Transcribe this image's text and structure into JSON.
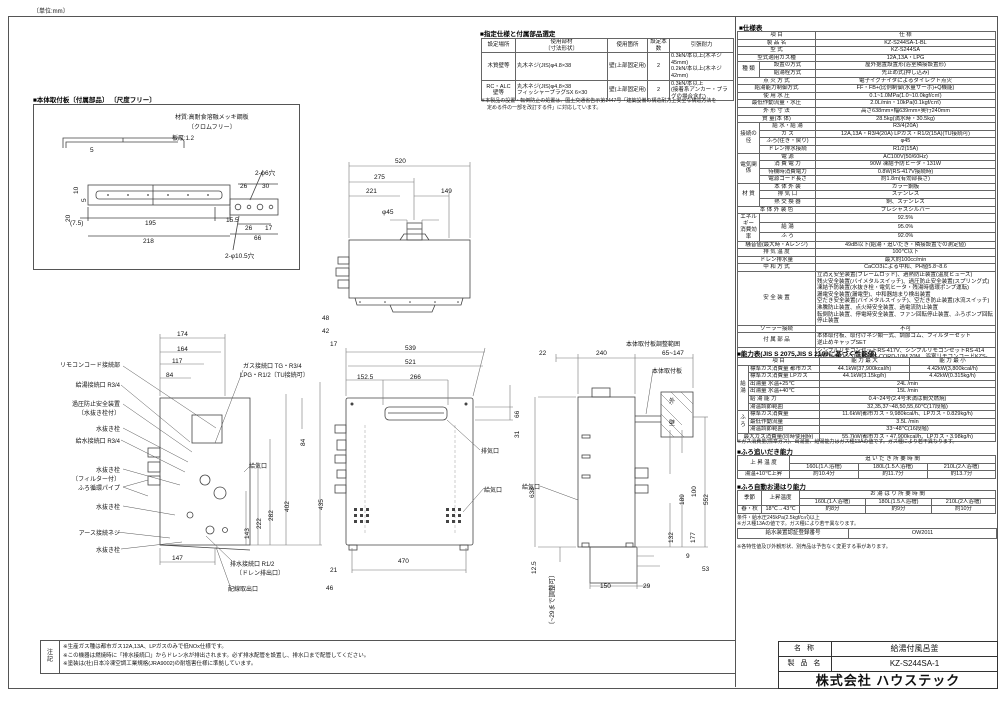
{
  "unit_note": "〔単位:mm〕",
  "supplied_parts": {
    "title": "■指定仕様と付属部品選定",
    "rows": [
      [
        {
          "t": "設定場所",
          "cl": "hd"
        },
        {
          "t": "使用部材\n〔寸法形状〕",
          "cl": "hd"
        },
        {
          "t": "使用箇所",
          "cl": "hd"
        },
        {
          "t": "設定本数",
          "cl": "hd"
        },
        {
          "t": "引張耐力",
          "cl": "hd"
        }
      ],
      [
        {
          "t": "木質壁等"
        },
        {
          "t": "丸木ネジ(JIS)φ4.8×38",
          "cl": "left"
        },
        {
          "t": "壁(上部固定用)"
        },
        {
          "t": "2"
        },
        {
          "t": "0.3kN/本以上(木ネジ45mm)\n0.2kN/本以上(木ネジ42mm)",
          "cl": "left"
        }
      ],
      [
        {
          "t": "RC・ALC\n壁等"
        },
        {
          "t": "丸木ネジ(JIS)φ4.8×38\nフィッシャープラグSX 6×30",
          "cl": "left"
        },
        {
          "t": "壁(上部固定用)"
        },
        {
          "t": "2"
        },
        {
          "t": "0.3kN/本以上\n(接着系アンカー・プラグの場合含む)",
          "cl": "left"
        }
      ]
    ],
    "note1": "※本製品の設置・転倒防止の処置は、国土交通省告示第1447号「建築設備の構造耐力上安全な構造方法を",
    "note2": "定める件の一部を改訂する件」に対応しています。"
  },
  "mounting_plate": {
    "title": "■本体取付板〔付属部品〕 〔尺度フリー〕",
    "material1": "材質:高耐食溶融メッキ鋼板",
    "material2": "〔クロムフリー〕",
    "thickness": "板厚:1.2",
    "d5p": "5",
    "d10": "10",
    "d5": "5",
    "d20": "20",
    "d7_5": "(7.5)",
    "d195": "195",
    "d15_5": "15.5",
    "d218": "218",
    "holes6": "2-φ6穴",
    "d26a": "26",
    "d30": "30",
    "d26b": "26",
    "d17": "17",
    "d66": "66",
    "holes10_5": "2-φ10.5穴"
  },
  "views": {
    "top": {
      "d520": "520",
      "d275": "275",
      "d221": "221",
      "d149": "149",
      "dphi45": "φ45"
    },
    "front": {
      "d48": "48",
      "d42": "42",
      "d17": "17",
      "d539": "539",
      "d521": "521",
      "d152_5": "152.5",
      "d266": "266",
      "d66": "66",
      "d31": "31",
      "d638": "638",
      "d470": "470",
      "d21": "21",
      "d46": "46",
      "exhaust": "排気口",
      "intake": "給気口"
    },
    "left": {
      "d174": "174",
      "d164": "164",
      "d117": "117",
      "d84t": "84",
      "gas1": "ガス接続口 TG・R3/4",
      "gas2": "LPG・R1/2〔TU接続可〕",
      "d84r": "84",
      "d435": "435",
      "d402": "402",
      "d282": "282",
      "d222": "222",
      "d143": "143",
      "d147": "147",
      "intake": "給気口",
      "drain1": "排水接続口 R1/2",
      "drain2": "〔ドレン排出口〕",
      "wiring": "配線取出口",
      "labels": {
        "remote": "リモコンコード接続部",
        "hot": "給湯接続口 R3/4",
        "relief1": "過圧防止安全装置",
        "relief2": "〔水抜き栓付〕",
        "plug1": "水抜き栓",
        "cold": "給水接続口 R3/4",
        "plug2": "水抜き栓",
        "filter": "〔フィルター付〕",
        "furo": "ふろ循環パイプ",
        "plug3": "水抜き栓",
        "earth": "アース接続ネジ",
        "plug4": "水抜き栓"
      }
    },
    "right": {
      "range": "本体取付板調整範囲",
      "d22": "22",
      "d240": "240",
      "d65": "65~147",
      "plate": "本体取付板",
      "wall1": "外",
      "wall2": "壁",
      "d638": "638",
      "d552": "552",
      "d189": "189",
      "d100": "100",
      "d177": "177",
      "d132": "132",
      "intake": "給気口",
      "d12_5": "12.5",
      "adj": "〔~29まで調整可〕",
      "d9": "9",
      "d53": "53",
      "d150": "150",
      "d29": "29"
    }
  },
  "spec": {
    "title": "■仕様表",
    "rows": [
      [
        {
          "t": "項   目",
          "cs": 2,
          "cl": "hd"
        },
        {
          "t": "仕   様",
          "cl": "hd"
        }
      ],
      [
        {
          "t": "製 品 名",
          "cs": 2
        },
        {
          "t": "KZ-S244SA-1-BL"
        }
      ],
      [
        {
          "t": "型 式",
          "cs": 2
        },
        {
          "t": "KZ-S244SA"
        }
      ],
      [
        {
          "t": "型式適用ガス種",
          "cs": 2
        },
        {
          "t": "12A,13A・LPG"
        }
      ],
      [
        {
          "t": "種 類",
          "rs": 2
        },
        {
          "t": "設置の方式"
        },
        {
          "t": "屋外据置設置形(浴室隣接設置形)"
        }
      ],
      [
        {
          "t": "給湯栓方式"
        },
        {
          "t": "先止め式(押し込み)"
        }
      ],
      [
        {
          "t": "点 火 方 式",
          "cs": 2
        },
        {
          "t": "電子イグナイタによるダイレクト点火"
        }
      ],
      [
        {
          "t": "給湯能力制御方式",
          "cs": 2
        },
        {
          "t": "FF・FB+(比例制御(水量サーボ)+Q機能)"
        }
      ],
      [
        {
          "t": "使 用 水 圧",
          "cs": 2
        },
        {
          "t": "0.1~1.0MPa(1.0~10.0kgf/c㎡)"
        }
      ],
      [
        {
          "t": "最低作動流量・水圧",
          "cs": 2
        },
        {
          "t": "2.0L/min・10kPa(0.1kgf/c㎡)"
        }
      ],
      [
        {
          "t": "外 形 寸 法",
          "cs": 2
        },
        {
          "t": "高さ638mm×幅639mm×奥行240mm"
        }
      ],
      [
        {
          "t": "質 量(本 体)",
          "cs": 2
        },
        {
          "t": "28.5kg(満水時・30.5kg)"
        }
      ],
      [
        {
          "t": "接続の径",
          "rs": 4
        },
        {
          "t": "給 水・給 湯"
        },
        {
          "t": "R3/4(20A)"
        }
      ],
      [
        {
          "t": "ガ ス"
        },
        {
          "t": "12A,13A・R3/4(20A) LPガス・R1/2(15A)(TU接続可)"
        }
      ],
      [
        {
          "t": "ふろ(往き・戻り)"
        },
        {
          "t": "φ45"
        }
      ],
      [
        {
          "t": "ドレン排水接続"
        },
        {
          "t": "R1/2(15A)"
        }
      ],
      [
        {
          "t": "電気関係",
          "rs": 4
        },
        {
          "t": "電 源"
        },
        {
          "t": "AC100V(50/60Hz)"
        }
      ],
      [
        {
          "t": "消 費 電 力"
        },
        {
          "t": "90W 凍結予防ヒータ・131W"
        }
      ],
      [
        {
          "t": "待機時消費電力"
        },
        {
          "t": "0.8W(RS-417V接続時)"
        }
      ],
      [
        {
          "t": "電源コード長さ"
        },
        {
          "t": "約1.8m(有効部長さ)"
        }
      ],
      [
        {
          "t": "材 質",
          "rs": 3
        },
        {
          "t": "本 体 外 装"
        },
        {
          "t": "カラー鋼板"
        }
      ],
      [
        {
          "t": "排 気 口"
        },
        {
          "t": "ステンレス"
        }
      ],
      [
        {
          "t": "熱 交 換 器"
        },
        {
          "t": "銅、ステンレス"
        }
      ],
      [
        {
          "t": "本 体 外 装 色",
          "cs": 2
        },
        {
          "t": "プレシャスシルバー"
        }
      ],
      [
        {
          "t": "エネルギー\n消費効率",
          "rs": 3
        },
        {
          "t": ""
        },
        {
          "t": "92.5%"
        }
      ],
      [
        {
          "t": "給 湯"
        },
        {
          "t": "95.0%"
        }
      ],
      [
        {
          "t": "ふ ろ"
        },
        {
          "t": "92.0%"
        }
      ],
      [
        {
          "t": "騒音値(最大時・Aレンジ)",
          "cs": 2
        },
        {
          "t": "49dB以下(給湯・追いだき・隣接設置での測定値)"
        }
      ],
      [
        {
          "t": "排 気 温 度",
          "cs": 2
        },
        {
          "t": "100℃以下"
        }
      ],
      [
        {
          "t": "ドレン排水量",
          "cs": 2
        },
        {
          "t": "最大約100cc/min"
        }
      ],
      [
        {
          "t": "中 和 方 式",
          "cs": 2
        },
        {
          "t": "CaCO3による中和、PH値5.8~8.6"
        }
      ],
      [
        {
          "t": "安 全 装 置",
          "cs": 2
        },
        {
          "t": "立消え安全装置(フレームロッド)、過熱防止装置(温度ヒューズ)\n残火安全装置(バイメタルスイッチ)、過圧防止安全装置(スプリング式)\n凍結予防装置(水抜き栓・電気ヒータ・残湯時循環ポンプ運転)\n漏電安全装置(漏電型)、中和器詰まり検出装置\n空だき安全装置(バイメタルスイッチ)、空だき防止装置(水流スイッチ)\n沸騰防止装置、点火時安全装置、過電流防止装置\n転倒防止装置、停電時安全装置、ファン回転停止装置、ふろポンプ回転停止装置",
          "cl": "left"
        }
      ],
      [
        {
          "t": "ソーラー接続",
          "cs": 2
        },
        {
          "t": "不可"
        }
      ],
      [
        {
          "t": "付 属 部 品",
          "cs": 2
        },
        {
          "t": "本体取付板、取付けネジ類一式、調節ゴム、フィルターセット\n逆止めキャップSET",
          "cl": "left"
        }
      ],
      [
        {
          "t": "別 売 品",
          "cs": 2
        },
        {
          "t": "シンプルリモコンセットRS-417V、シンプルリモコンセットRS-414\n台所リモコンコードKZS-CORD-10M,20M、浴室リモコンコードKZS-FCORD-10M,20M\n増設リモコンコードKZG-C131、壁貫通カバーKZN-350\n浴槽用循環金具セットST-CV-SET、循環金具用延長セットKR-404Z",
          "cl": "left"
        }
      ]
    ]
  },
  "capacity": {
    "title": "■能力表(JIS S 2075,JIS S 2109に基づく性能値)",
    "rows": [
      [
        {
          "t": "項   目",
          "cs": 2,
          "cl": "hd"
        },
        {
          "t": "能 力 最 大",
          "cl": "hd"
        },
        {
          "t": "能 力 最 小",
          "cl": "hd"
        }
      ],
      [
        {
          "t": "給湯",
          "rs": 6
        },
        {
          "t": "標準ガス消費量 都市ガス",
          "cl": "left"
        },
        {
          "t": "44.1kW(37,900kcal/h)"
        },
        {
          "t": "4.42kW(3,800kcal/h)"
        }
      ],
      [
        {
          "t": "標準ガス消費量 LPガス",
          "cl": "left"
        },
        {
          "t": "44.1kW(3.15kg/h)"
        },
        {
          "t": "4.42kW(0.315kg/h)"
        }
      ],
      [
        {
          "t": "出湯量 水温+25℃",
          "cl": "left"
        },
        {
          "t": "24L /min",
          "cs": 2
        }
      ],
      [
        {
          "t": "出湯量 水温+40℃",
          "cl": "left"
        },
        {
          "t": "15L /min",
          "cs": 2
        }
      ],
      [
        {
          "t": "給 湯 能 力",
          "cl": "left"
        },
        {
          "t": "0.4~24号(2.4号未満は間欠燃焼)",
          "cs": 2
        }
      ],
      [
        {
          "t": "湯温調節範囲",
          "cl": "left"
        },
        {
          "t": "32,35,37~48,50,55,60℃(17段階)",
          "cs": 2
        }
      ],
      [
        {
          "t": "ふろ",
          "rs": 3
        },
        {
          "t": "標準ガス消費量",
          "cl": "left"
        },
        {
          "t": "11.6kW(都市ガス・9,980kcal/h、LPガス・0.829kg/h)",
          "cs": 2
        }
      ],
      [
        {
          "t": "最低作動流量",
          "cl": "left"
        },
        {
          "t": "3.5L /min",
          "cs": 2
        }
      ],
      [
        {
          "t": "湯温調節範囲",
          "cl": "left"
        },
        {
          "t": "33~48℃(16段階)",
          "cs": 2
        }
      ],
      [
        {
          "t": "最大ガス消費量(同時使用時)",
          "cs": 2
        },
        {
          "t": "55.7kW(都市ガス・47,900kcal/h、LPガス・3.98kg/h)",
          "cs": 2
        }
      ]
    ],
    "note": "※ガス消費量(標準ガス)、出湯量、給湯能力はガス種13Aの値です。ガス種により若干異なります。"
  },
  "reheat": {
    "title": "■ふろ追いだき能力",
    "rows": [
      [
        {
          "t": "上 昇 温 度",
          "rs": 2,
          "cl": "hd"
        },
        {
          "t": "追 い だ き 所 要 時 間",
          "cs": 3,
          "cl": "hd"
        }
      ],
      [
        {
          "t": "160L(1人浴槽)",
          "cl": "hd"
        },
        {
          "t": "180L(1.5人浴槽)",
          "cl": "hd"
        },
        {
          "t": "210L(2人浴槽)",
          "cl": "hd"
        }
      ],
      [
        {
          "t": "湯温+10℃上昇"
        },
        {
          "t": "約10.4分"
        },
        {
          "t": "約11.7分"
        },
        {
          "t": "約13.7分"
        }
      ]
    ]
  },
  "autofill": {
    "title": "■ふろ自動お湯はり能力",
    "rows": [
      [
        {
          "t": "季節",
          "rs": 2,
          "cl": "hd"
        },
        {
          "t": "上昇温度",
          "rs": 2,
          "cl": "hd"
        },
        {
          "t": "お 湯 は り 所 要 時 間",
          "cs": 3,
          "cl": "hd"
        }
      ],
      [
        {
          "t": "160L(1人浴槽)",
          "cl": "hd"
        },
        {
          "t": "180L(1.5人浴槽)",
          "cl": "hd"
        },
        {
          "t": "210L(2人浴槽)",
          "cl": "hd"
        }
      ],
      [
        {
          "t": "春・秋"
        },
        {
          "t": "18℃→43℃"
        },
        {
          "t": "約8分"
        },
        {
          "t": "約9分"
        },
        {
          "t": "約10分"
        }
      ]
    ],
    "note1": "条件・給水圧245kPa(2.5kgf/c㎡)以上",
    "note2": "※ガス種13Aの値です。ガス種により若干異なります。"
  },
  "cert": {
    "label": "給水装置認証登録番号",
    "value": "OW2011"
  },
  "footer_note": "※各特性値及び外観形状、別売品は予告なく変更する事があります。",
  "notes_box": {
    "label": "注\n記",
    "lines": "※生産ガス種は都市ガス12A,13A、LPガスのみで低NOx仕様です。\n※この機器は燃焼時に「排水接続口」からドレン水が排出されます。必ず排水配管を設置し、排水口まで配管してください。\n※塗装は(社)日本冷凍空調工業規格(JRA9002)の耐塩害仕様に準拠しています。"
  },
  "title_block": {
    "name_label": "名 称",
    "name": "給湯付風呂釜",
    "product_label": "製 品 名",
    "product": "KZ-S244SA-1",
    "company": "株式会社 ハウステック"
  }
}
